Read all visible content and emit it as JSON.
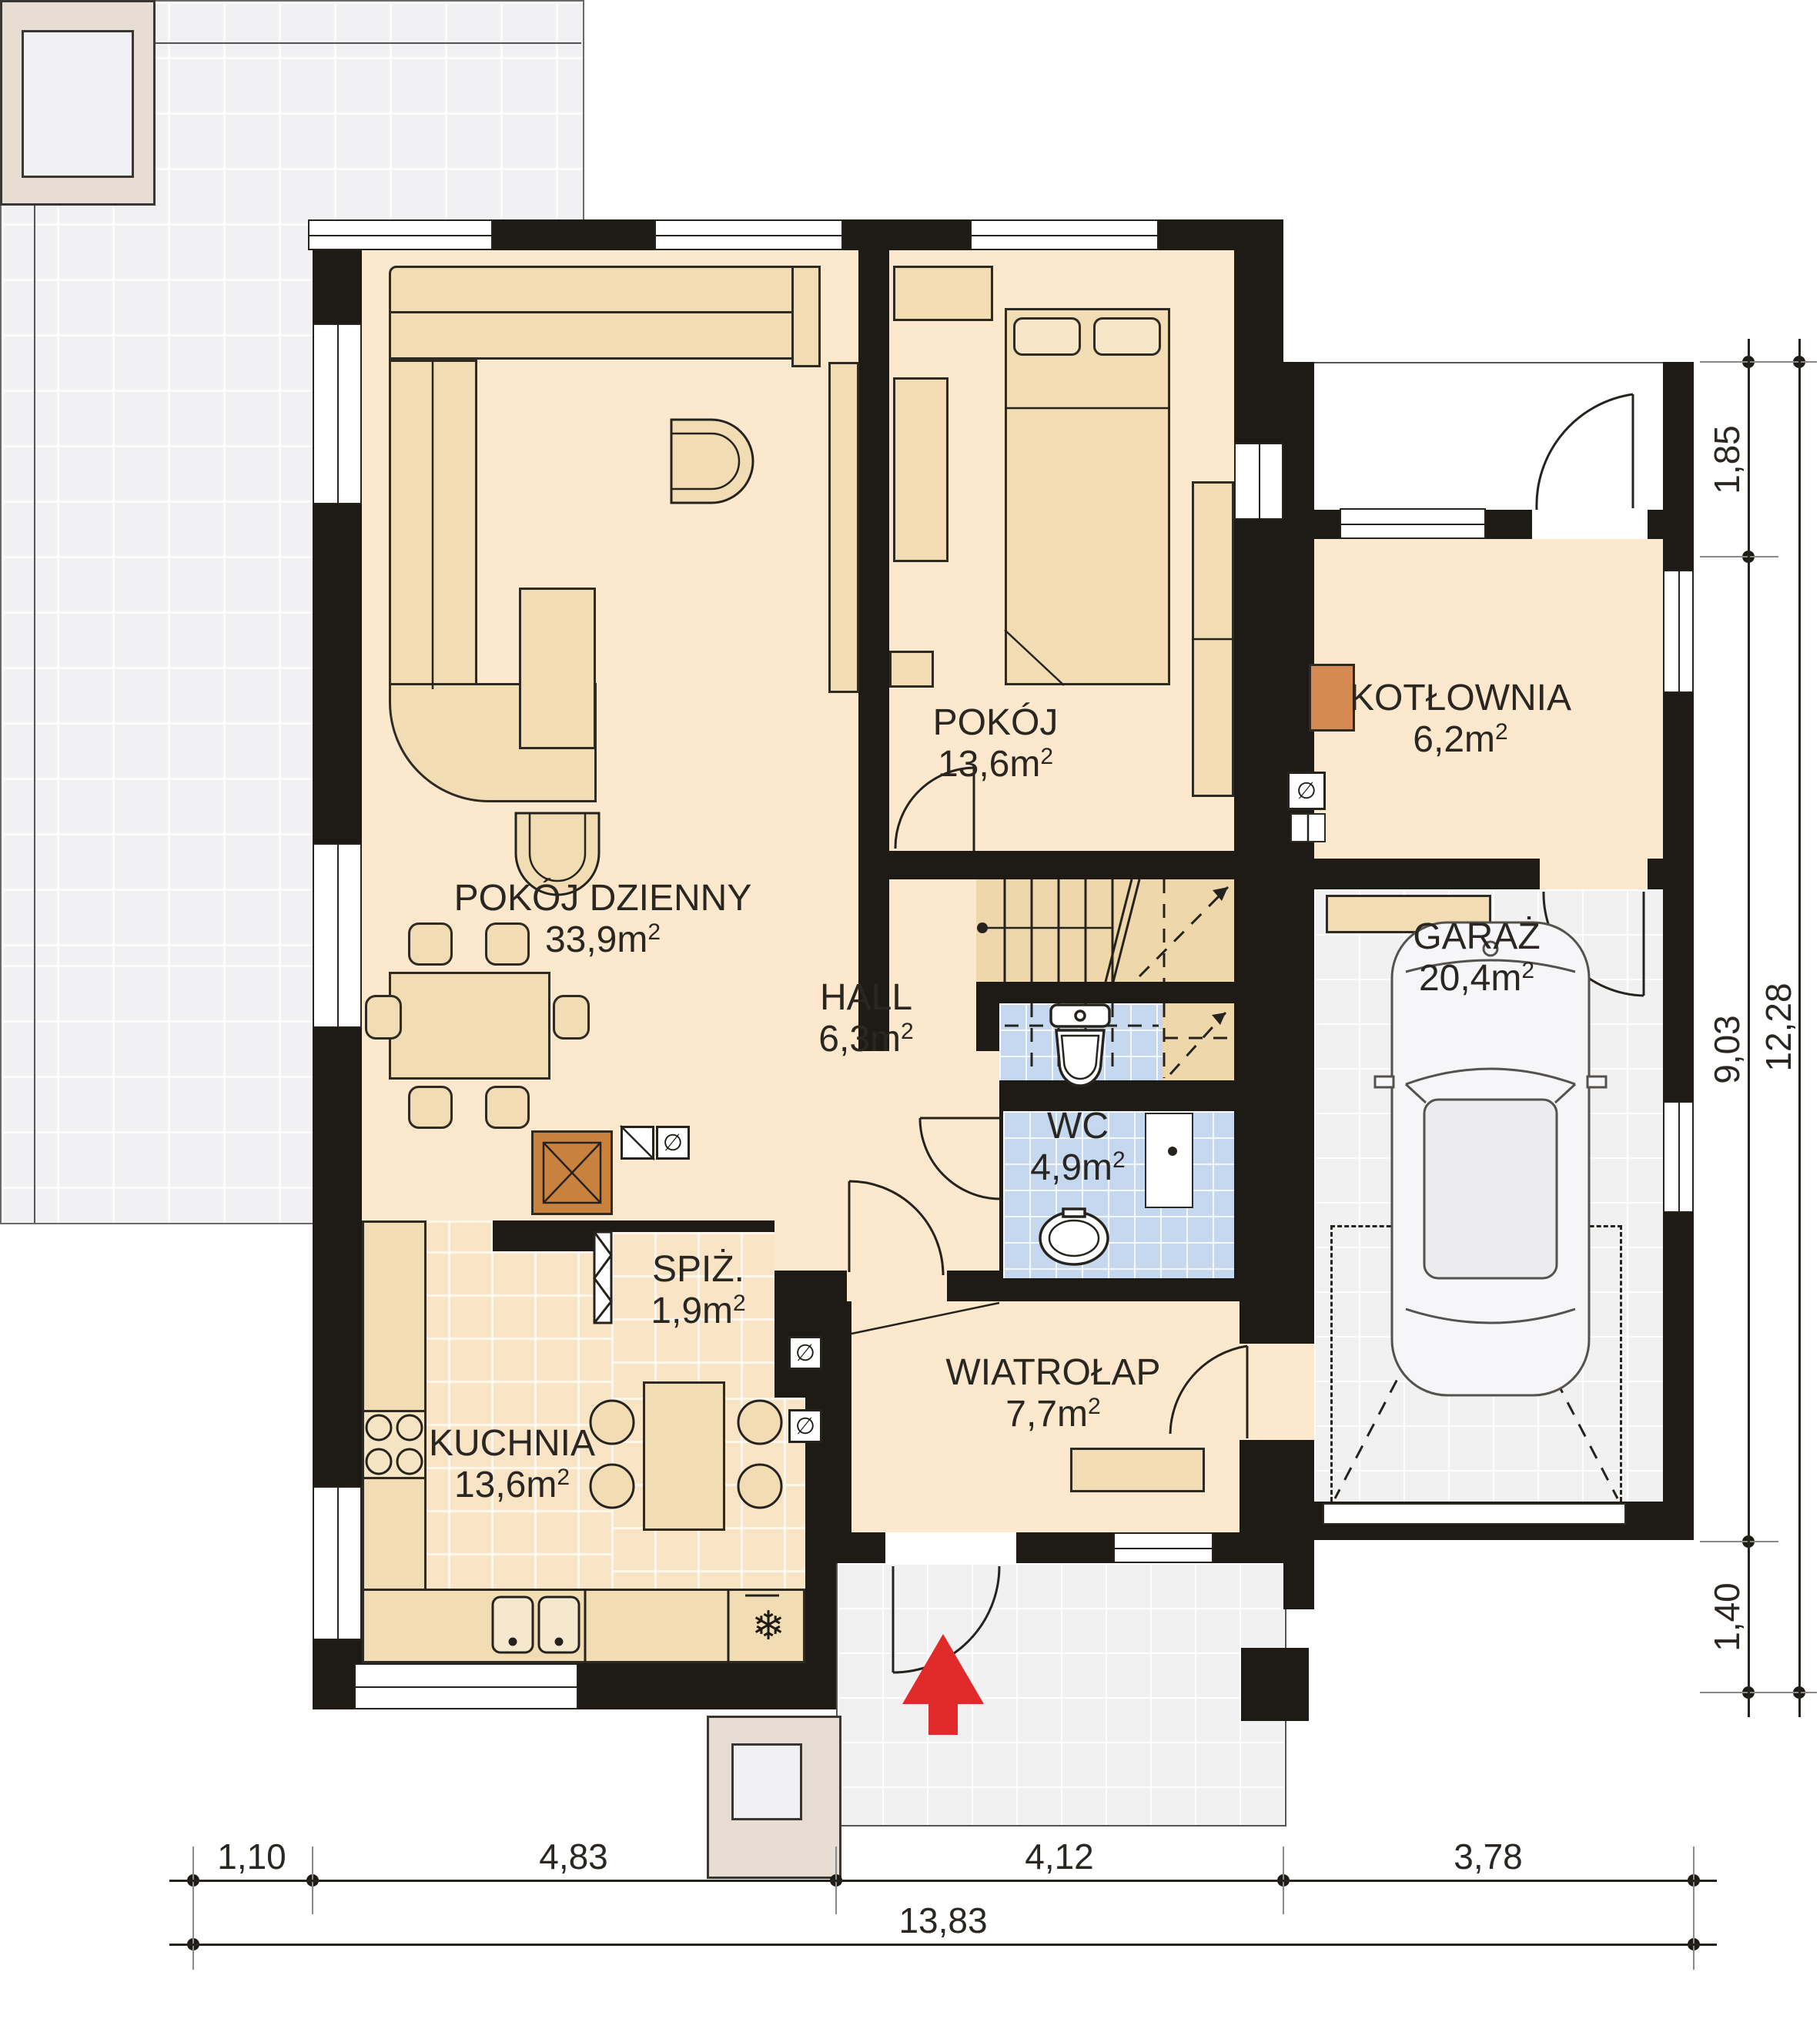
{
  "plan": {
    "type": "floor-plan",
    "language": "pl",
    "rooms": [
      {
        "name": "POKÓJ DZIENNY",
        "area": "33,9m",
        "sup": "2"
      },
      {
        "name": "POKÓJ",
        "area": "13,6m",
        "sup": "2"
      },
      {
        "name": "KOTŁOWNIA",
        "area": "6,2m",
        "sup": "2"
      },
      {
        "name": "GARAŻ",
        "area": "20,4m",
        "sup": "2"
      },
      {
        "name": "HALL",
        "area": "6,3m",
        "sup": "2"
      },
      {
        "name": "WC",
        "area": "4,9m",
        "sup": "2"
      },
      {
        "name": "SPIŻ.",
        "area": "1,9m",
        "sup": "2"
      },
      {
        "name": "KUCHNIA",
        "area": "13,6m",
        "sup": "2"
      },
      {
        "name": "WIATROŁAP",
        "area": "7,7m",
        "sup": "2"
      }
    ],
    "dimensions": {
      "right": {
        "d1": "1,85",
        "d2": "9,03",
        "d3": "1,40",
        "total": "12,28"
      },
      "bottom": {
        "d1": "1,10",
        "d2": "4,83",
        "d3": "4,12",
        "d4": "3,78",
        "total": "13,83"
      }
    },
    "icons": {
      "fridge": "❄",
      "vent": "∅"
    },
    "colors": {
      "wall": "#1e1b17",
      "room_floor": "#fbe8cd",
      "kitchen_tile": "#f9e4c6",
      "wc_tile": "#c6d8ef",
      "garage_floor": "#f1f1f2",
      "terrace": "#f1f1f3",
      "furniture": "#f2dcb3",
      "boiler": "#d48a52",
      "fireplace": "#c9813e",
      "entrance_arrow": "#e12b2b"
    }
  }
}
